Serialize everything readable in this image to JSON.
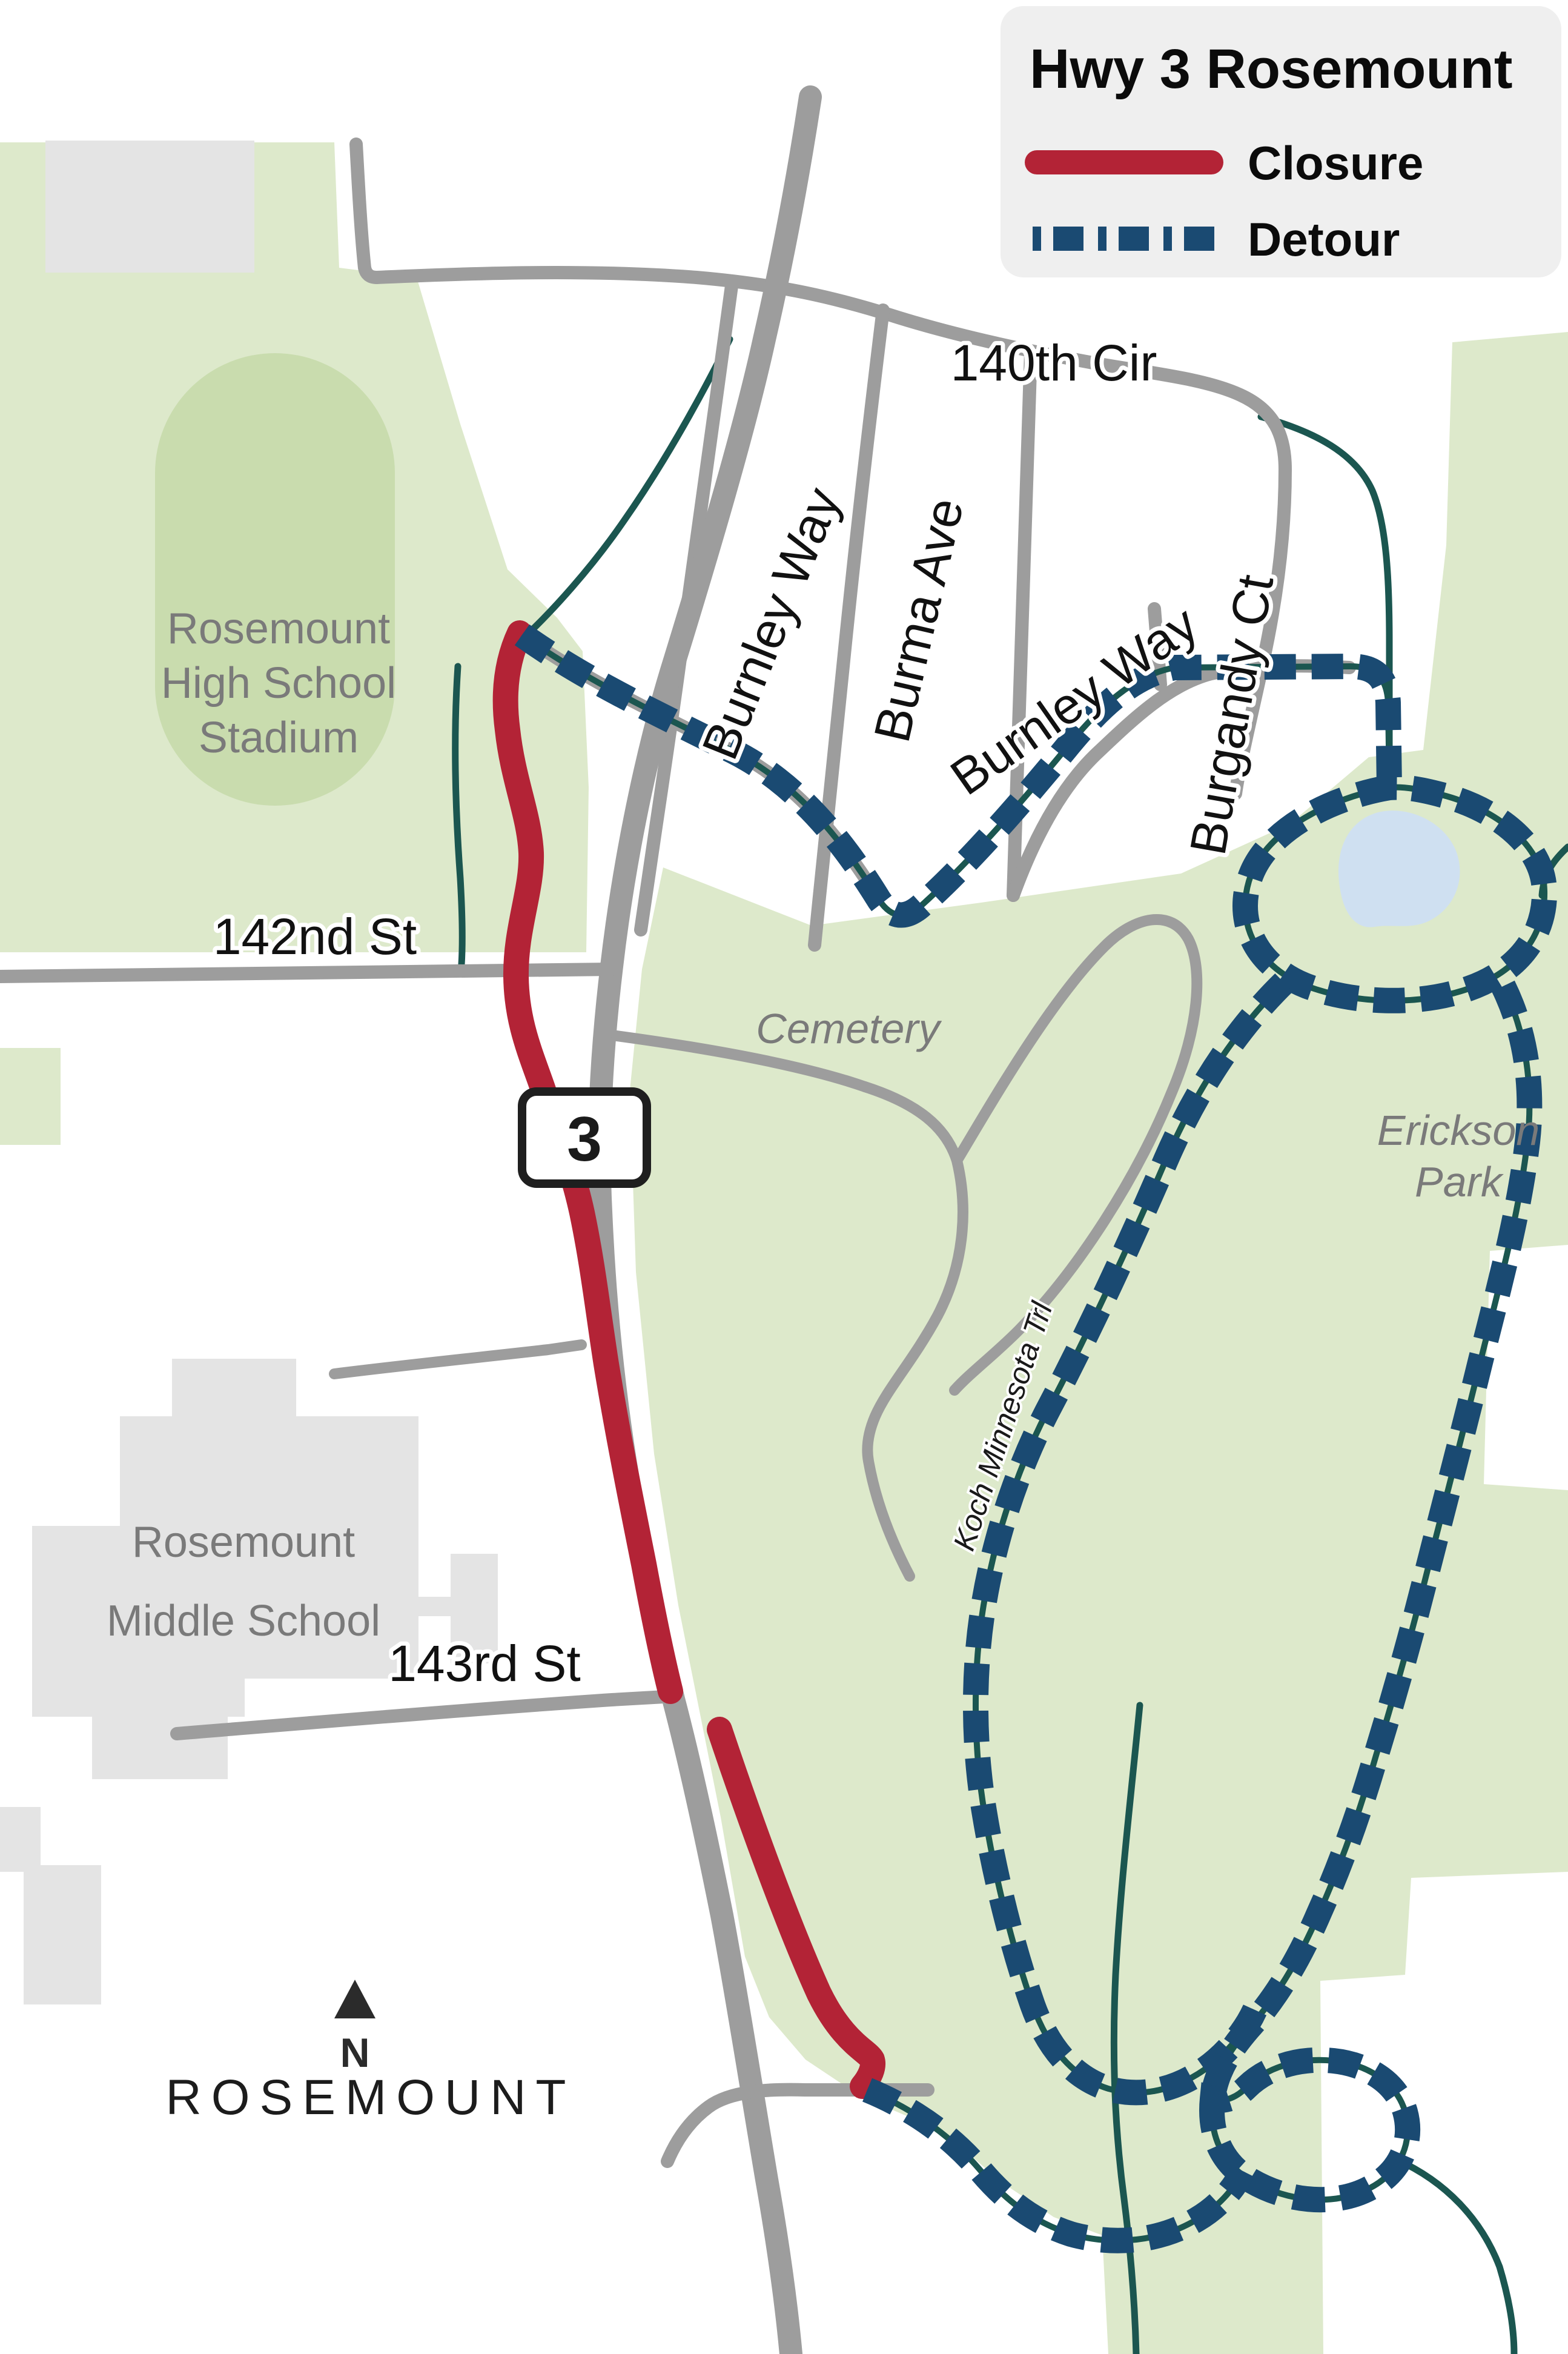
{
  "legend": {
    "title": "Hwy 3 Rosemount",
    "closure_label": "Closure",
    "detour_label": "Detour"
  },
  "labels": {
    "cir140": "140th Cir",
    "burnley_west": "Burnley Way",
    "burma": "Burma Ave",
    "burnley_east": "Burnley Way",
    "burgandy": "Burgandy Ct",
    "st142": "142nd St",
    "st143": "143rd St",
    "koch": "Koch Minnesota Trl",
    "stadium_l1": "Rosemount",
    "stadium_l2": "High School",
    "stadium_l3": "Stadium",
    "cemetery": "Cemetery",
    "erickson_l1": "Erickson",
    "erickson_l2": "Park",
    "middle_l1": "Rosemount",
    "middle_l2": "Middle School",
    "city": "ROSEMOUNT",
    "shield": "3",
    "north": "N"
  },
  "colors": {
    "closure": "#b32336",
    "detour": "#1a4a72",
    "road": "#9d9d9d",
    "green": "#dde9cb",
    "green_dark": "#c9dcae",
    "pond": "#cfe0f1",
    "building": "#e4e4e4",
    "legend_bg": "#efefef",
    "stream": "#1b5650",
    "label_gray": "#7a7a7a"
  }
}
